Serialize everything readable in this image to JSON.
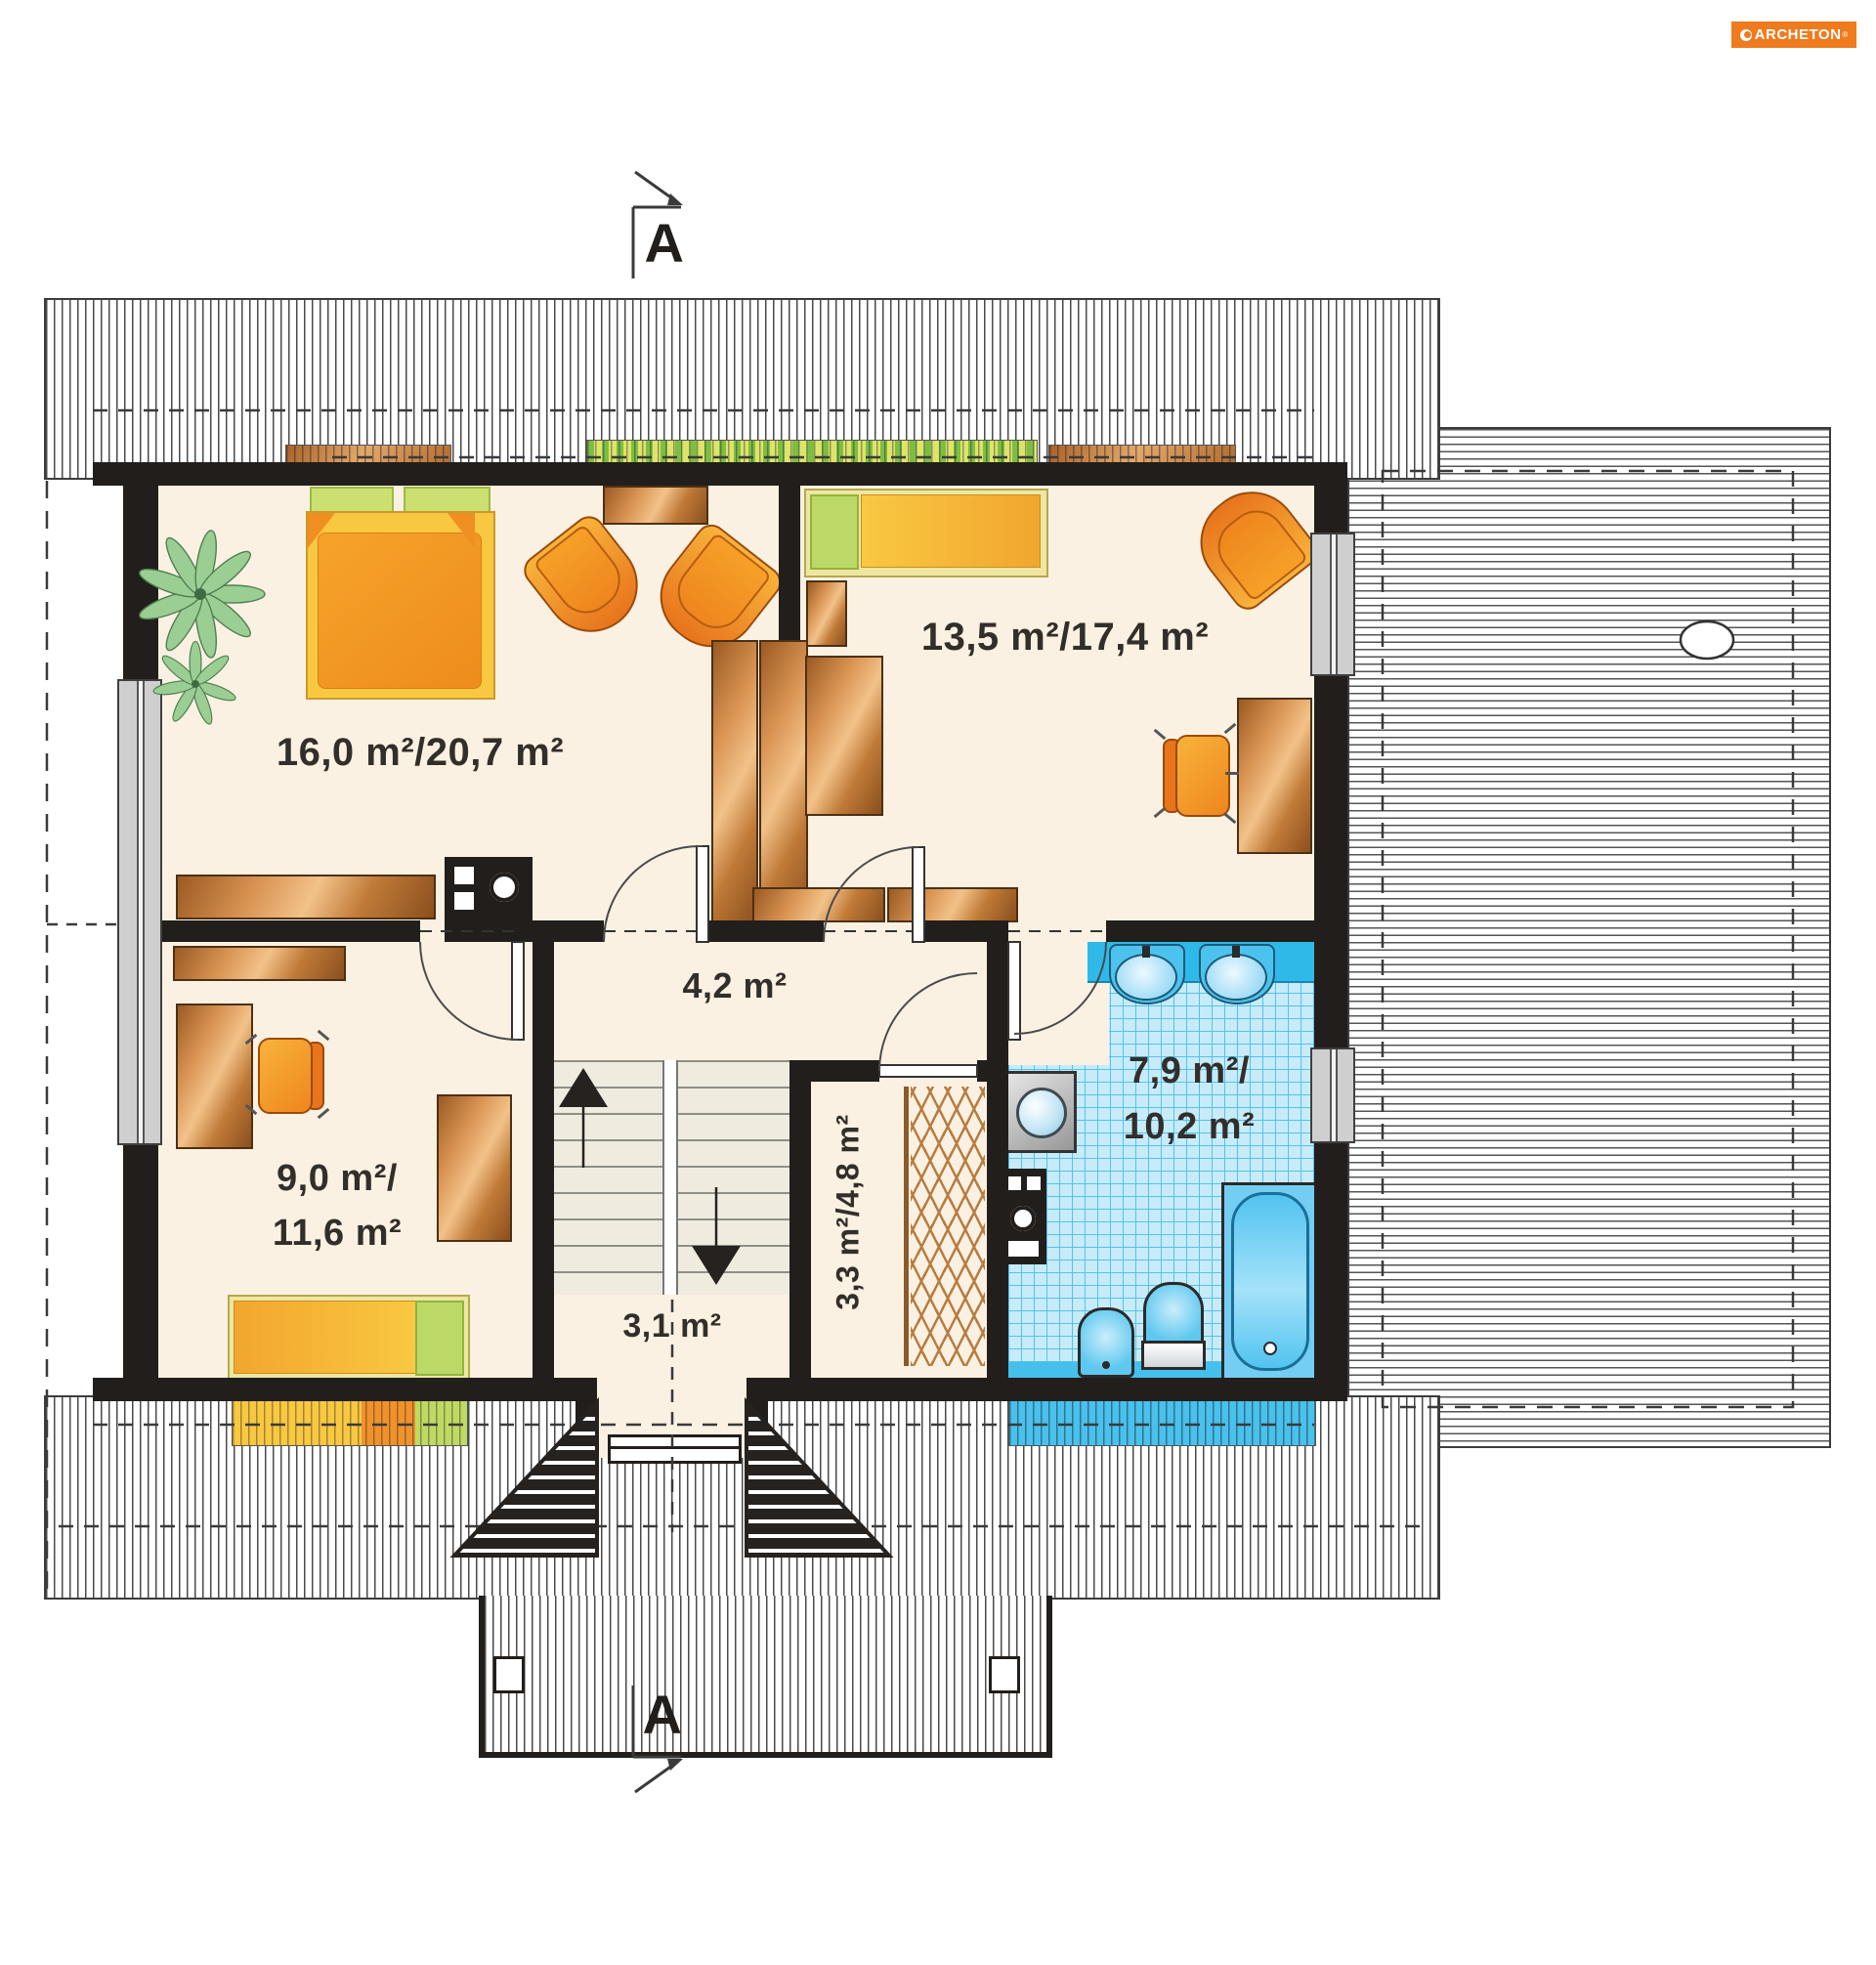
{
  "logo": {
    "text": "ARCHETON",
    "registered_mark": "®"
  },
  "section_markers": {
    "top_label": "A",
    "bottom_label": "A"
  },
  "rooms": {
    "bedroom_large": {
      "area_label": "16,0 m²/20,7 m²"
    },
    "bedroom_right": {
      "area_label": "13,5 m²/17,4 m²"
    },
    "hall": {
      "area_label": "4,2 m²"
    },
    "bedroom_small": {
      "area_label_line1": "9,0 m²/",
      "area_label_line2": "11,6 m²"
    },
    "vestibule": {
      "area_label": "3,1 m²"
    },
    "closet": {
      "area_label": "3,3 m²/4,8 m²"
    },
    "bathroom": {
      "area_label_line1": "7,9 m²/",
      "area_label_line2": "10,2 m²"
    }
  },
  "colors": {
    "wall": "#221E1B",
    "floor_cream": "#FBF1E2",
    "tile_background": "#C8EBFA",
    "tile_grid": "#51C3EE",
    "bath_fixture_blue": "#2FB9E9",
    "wood_brown": "#C98140",
    "furniture_orange": "#F08A1F",
    "bed_yellow": "#F9C841",
    "pillow_green": "#BCD968",
    "logo_orange": "#EE7B1E"
  }
}
